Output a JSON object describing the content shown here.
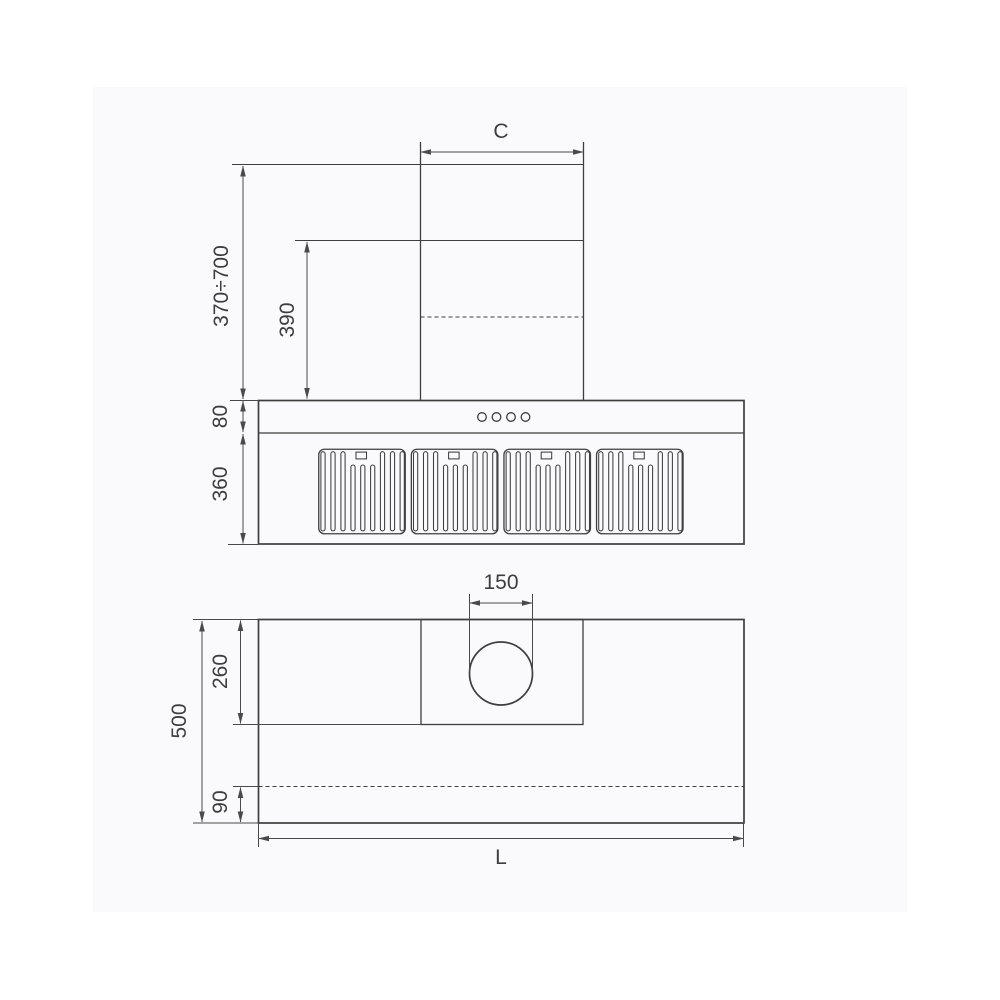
{
  "colors": {
    "page_background": "#ffffff",
    "canvas_background": "#fafafc",
    "object_line": "#3e3e3e",
    "dimension_line": "#4a4a4a",
    "text": "#3d3d3d"
  },
  "front_view": {
    "dimensions": {
      "chimney_width": "C",
      "chimney_height_range": "370÷700",
      "telescopic_section_height": "390",
      "control_band_height": "80",
      "body_height": "360"
    },
    "control_buttons_count": 4,
    "filter_panels_count": 4
  },
  "plan_view": {
    "dimensions": {
      "duct_outlet_diameter": "150",
      "duct_box_depth": "260",
      "total_depth": "500",
      "rear_edge_offset": "90",
      "total_length": "L"
    }
  }
}
